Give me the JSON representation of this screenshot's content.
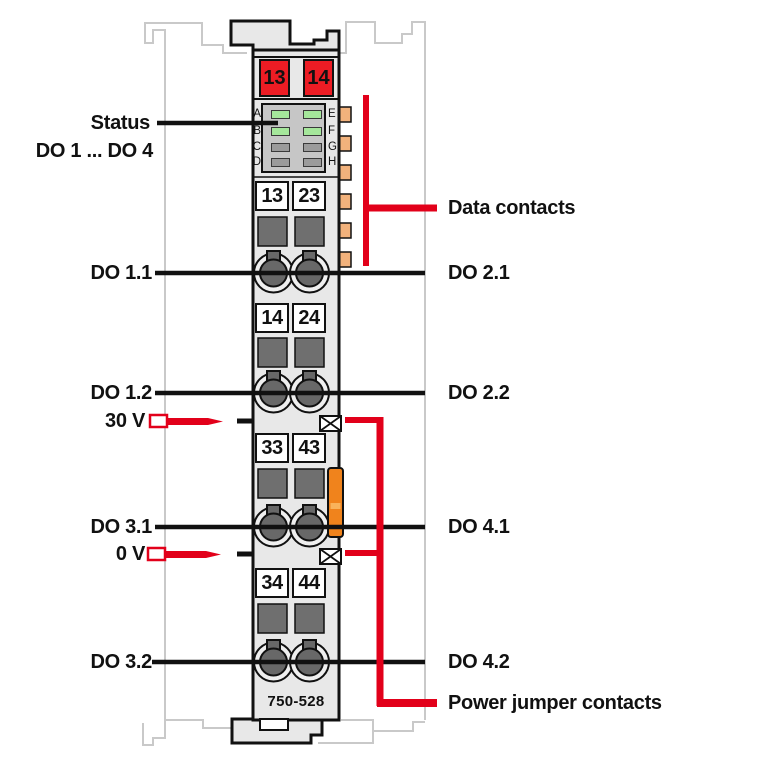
{
  "module": {
    "model": "750-528",
    "power_contacts": {
      "left": "13",
      "right": "14"
    },
    "led_panel": {
      "left_letters": [
        "A",
        "B",
        "C",
        "D"
      ],
      "right_letters": [
        "E",
        "F",
        "G",
        "H"
      ],
      "left_led_states": [
        "on",
        "on",
        "off",
        "off"
      ],
      "right_led_states": [
        "on",
        "on",
        "off",
        "off"
      ]
    },
    "terminal_rows": [
      {
        "left": "13",
        "right": "23"
      },
      {
        "left": "14",
        "right": "24"
      },
      {
        "left": "33",
        "right": "43"
      },
      {
        "left": "34",
        "right": "44"
      }
    ]
  },
  "callouts_left": {
    "status": "Status",
    "do_range": "DO 1 ... DO 4",
    "do_1_1": "DO 1.1",
    "do_1_2": "DO 1.2",
    "v_30": "30 V",
    "do_3_1": "DO 3.1",
    "v_0": "0 V",
    "do_3_2": "DO 3.2"
  },
  "callouts_right": {
    "do_2_1": "DO 2.1",
    "do_2_2": "DO 2.2",
    "do_4_1": "DO 4.1",
    "do_4_2": "DO 4.2",
    "data_contacts": "Data contacts",
    "power_jumper_contacts": "Power jumper contacts"
  },
  "colors": {
    "callout_red": "#e2001a",
    "power_contact_red": "#ed1c24",
    "led_on_green": "#a5e79b",
    "led_off_gray": "#9b9b9b",
    "latch_orange": "#f0831c",
    "data_contact_tan": "#f2b27c",
    "module_body_gray": "#e8e8e8",
    "led_panel_gray": "#c6c6c6",
    "neighbor_outline_gray": "#c9c9c9"
  }
}
